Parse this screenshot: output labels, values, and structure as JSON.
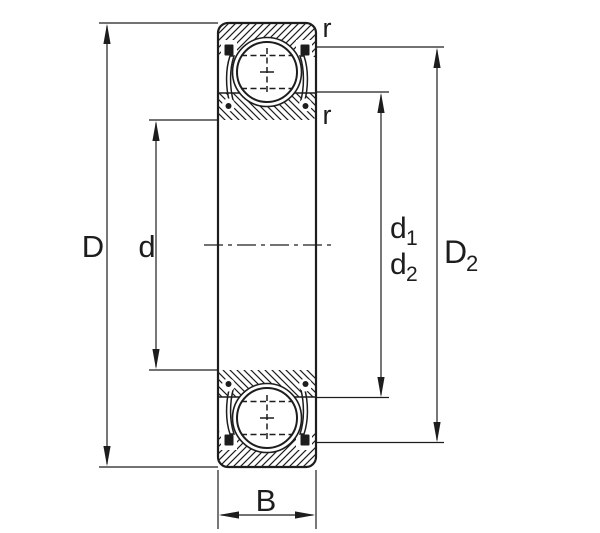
{
  "diagram": {
    "colors": {
      "ink": "#1d1d1d",
      "background": "#ffffff"
    },
    "labels": {
      "outer_diameter": "D",
      "bore_diameter": "d",
      "width": "B",
      "corner_radius_outer": "r",
      "corner_radius_inner": "r",
      "d1": {
        "base": "d",
        "sub": "1"
      },
      "d2": {
        "base": "d",
        "sub": "2"
      },
      "D2": {
        "base": "D",
        "sub": "2"
      }
    }
  }
}
